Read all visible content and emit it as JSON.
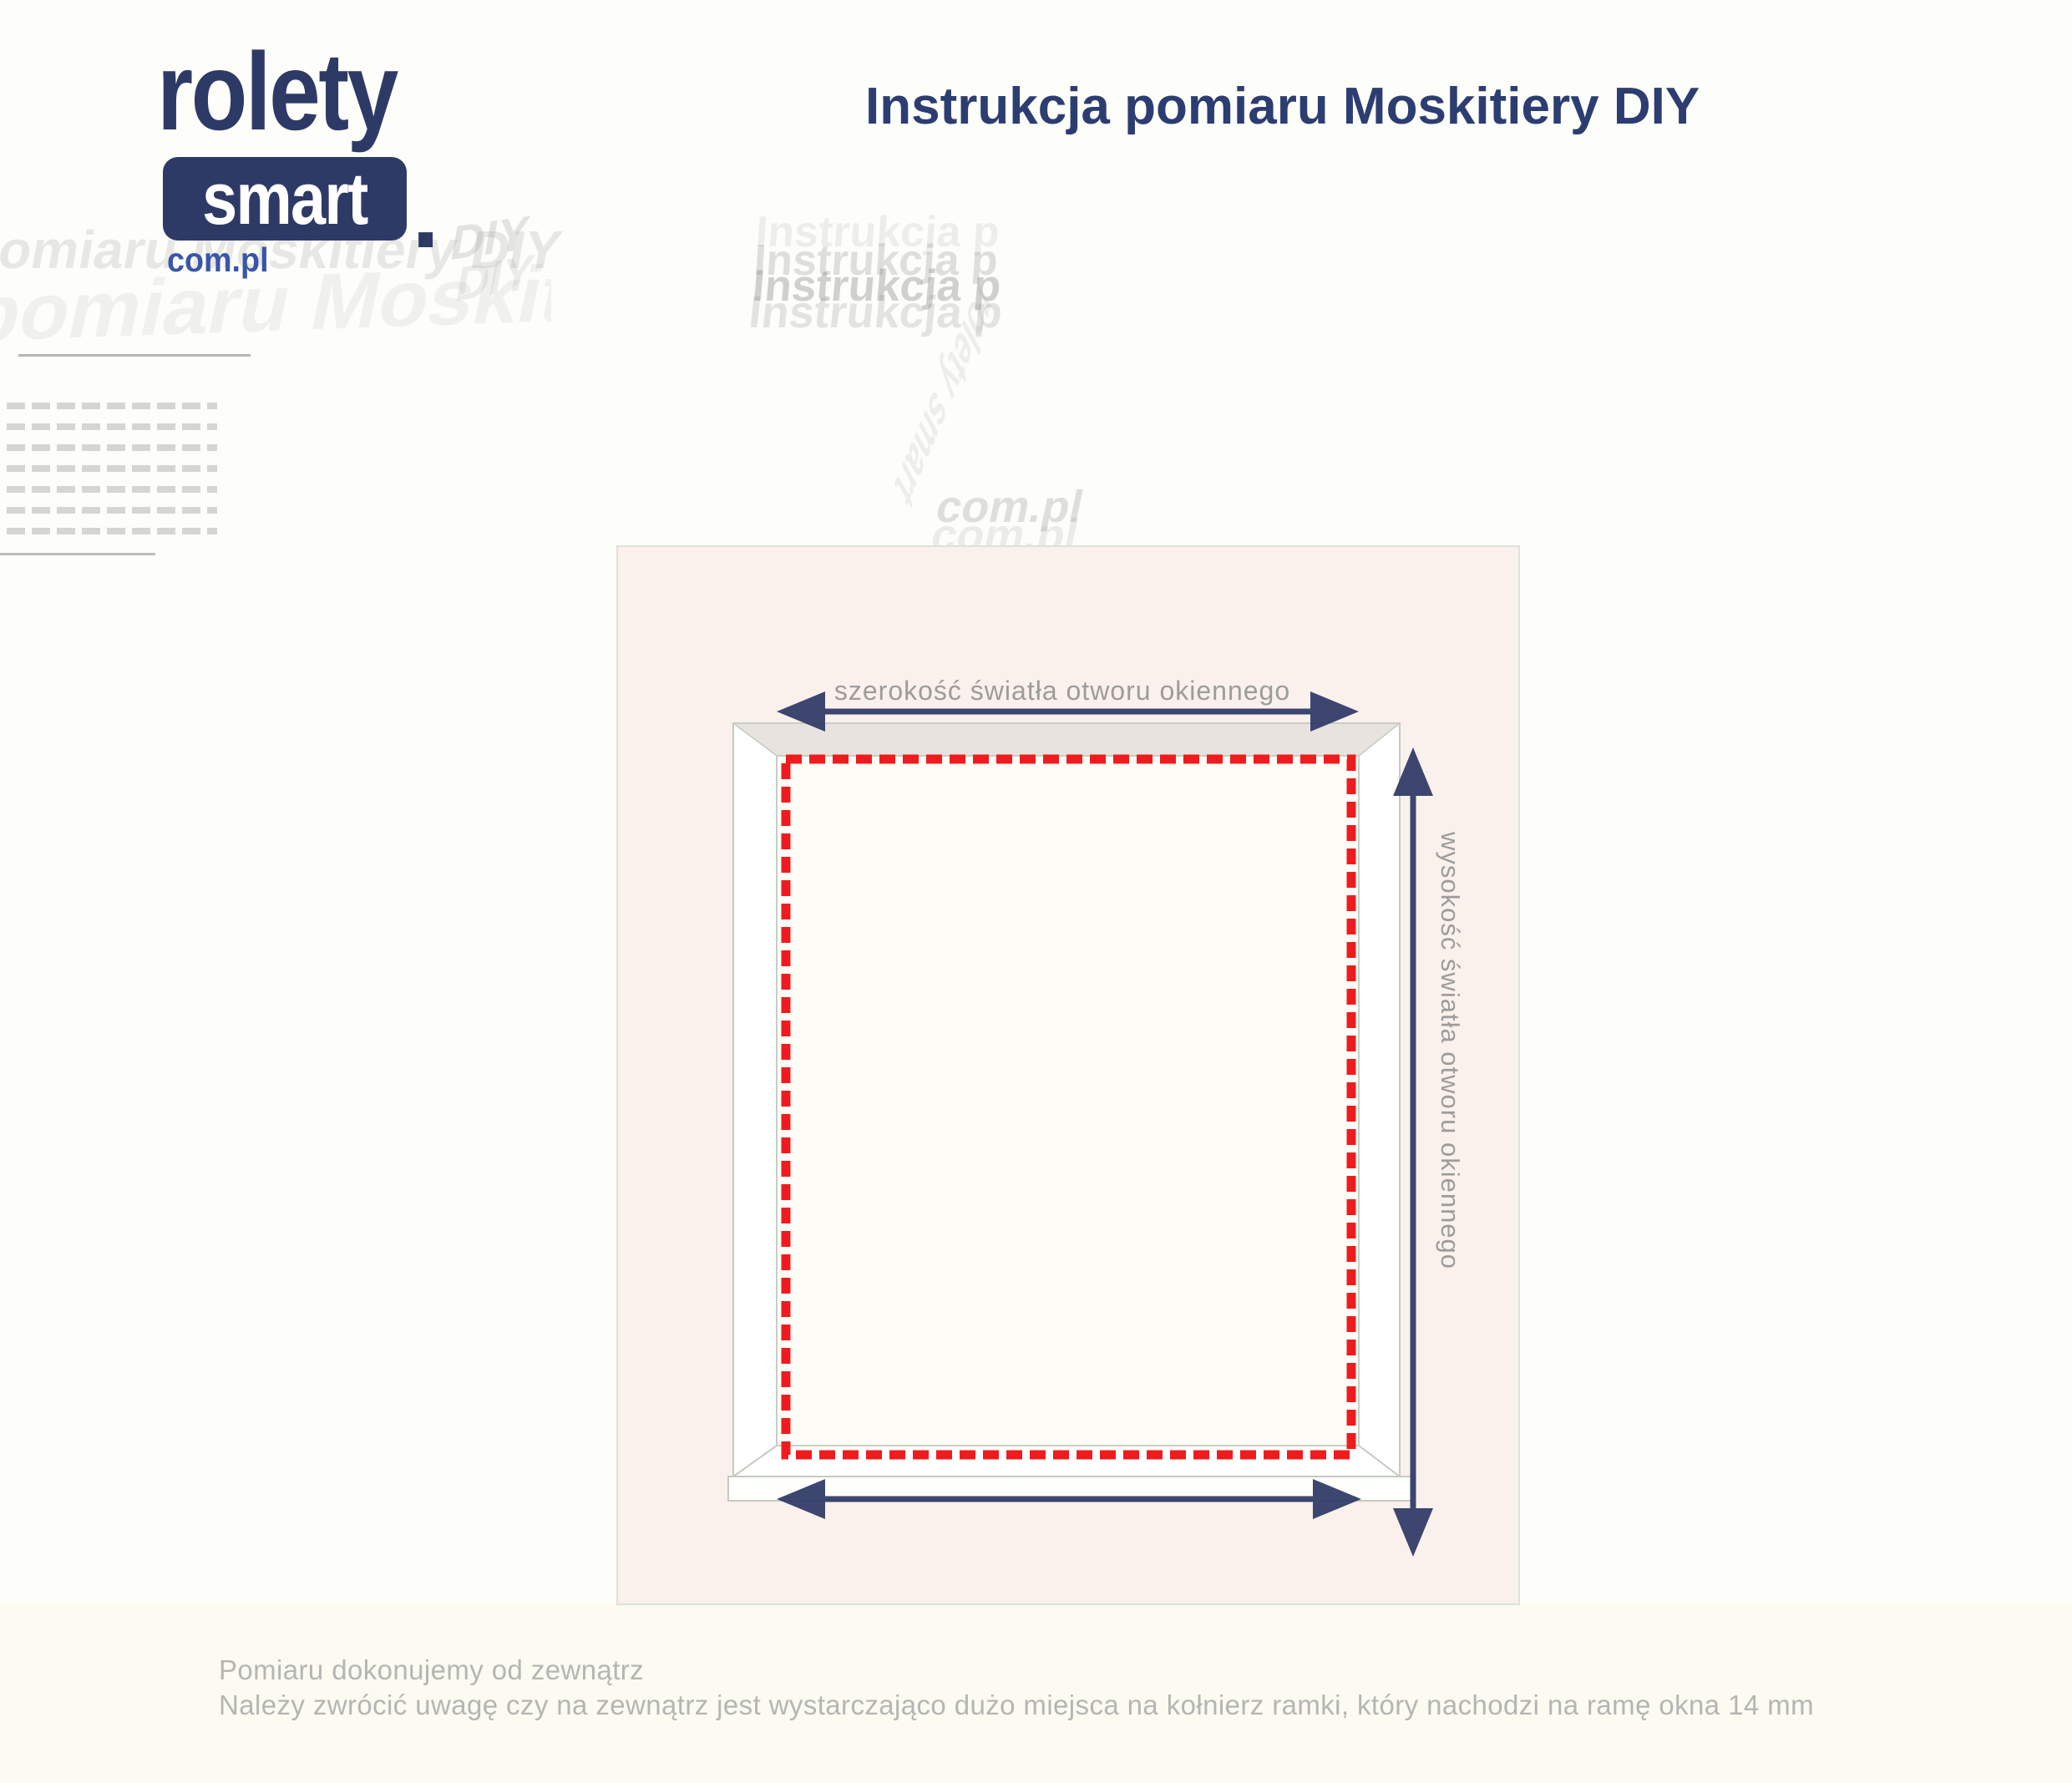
{
  "brand": {
    "logo_text": "rolety",
    "logo_badge": "smart",
    "logo_period": ".",
    "logo_domain": "com.pl",
    "navy": "#2e3a66",
    "blue": "#3a56a8"
  },
  "header": {
    "title": "Instrukcja pomiaru Moskitiery DIY",
    "title_color": "#2c3d72"
  },
  "diagram": {
    "width_label": "szerokość światła otworu okiennego",
    "height_label": "wysokość światła otworu okiennego",
    "panel_color": "#faf0ec",
    "arrow_color": "#2e3a66",
    "net_outline_color": "#ee1c1e",
    "frame_line_color": "#c3cbc0",
    "label_color": "#9c9c9c"
  },
  "footer": {
    "line1": "Pomiaru dokonujemy od zewnątrz",
    "line2": "Należy zwrócić uwagę czy na zewnątrz jest wystarczająco dużo miejsca na kołnierz ramki, który nachodzi na ramę okna 14 mm"
  },
  "watermark": {
    "title_echo": "Instrukcja p",
    "left_echo": "pomiaru Moskitiery DIY",
    "diy_echo": "DIY",
    "logo_echo": "rolety smart",
    "domain_echo": "com.pl"
  }
}
